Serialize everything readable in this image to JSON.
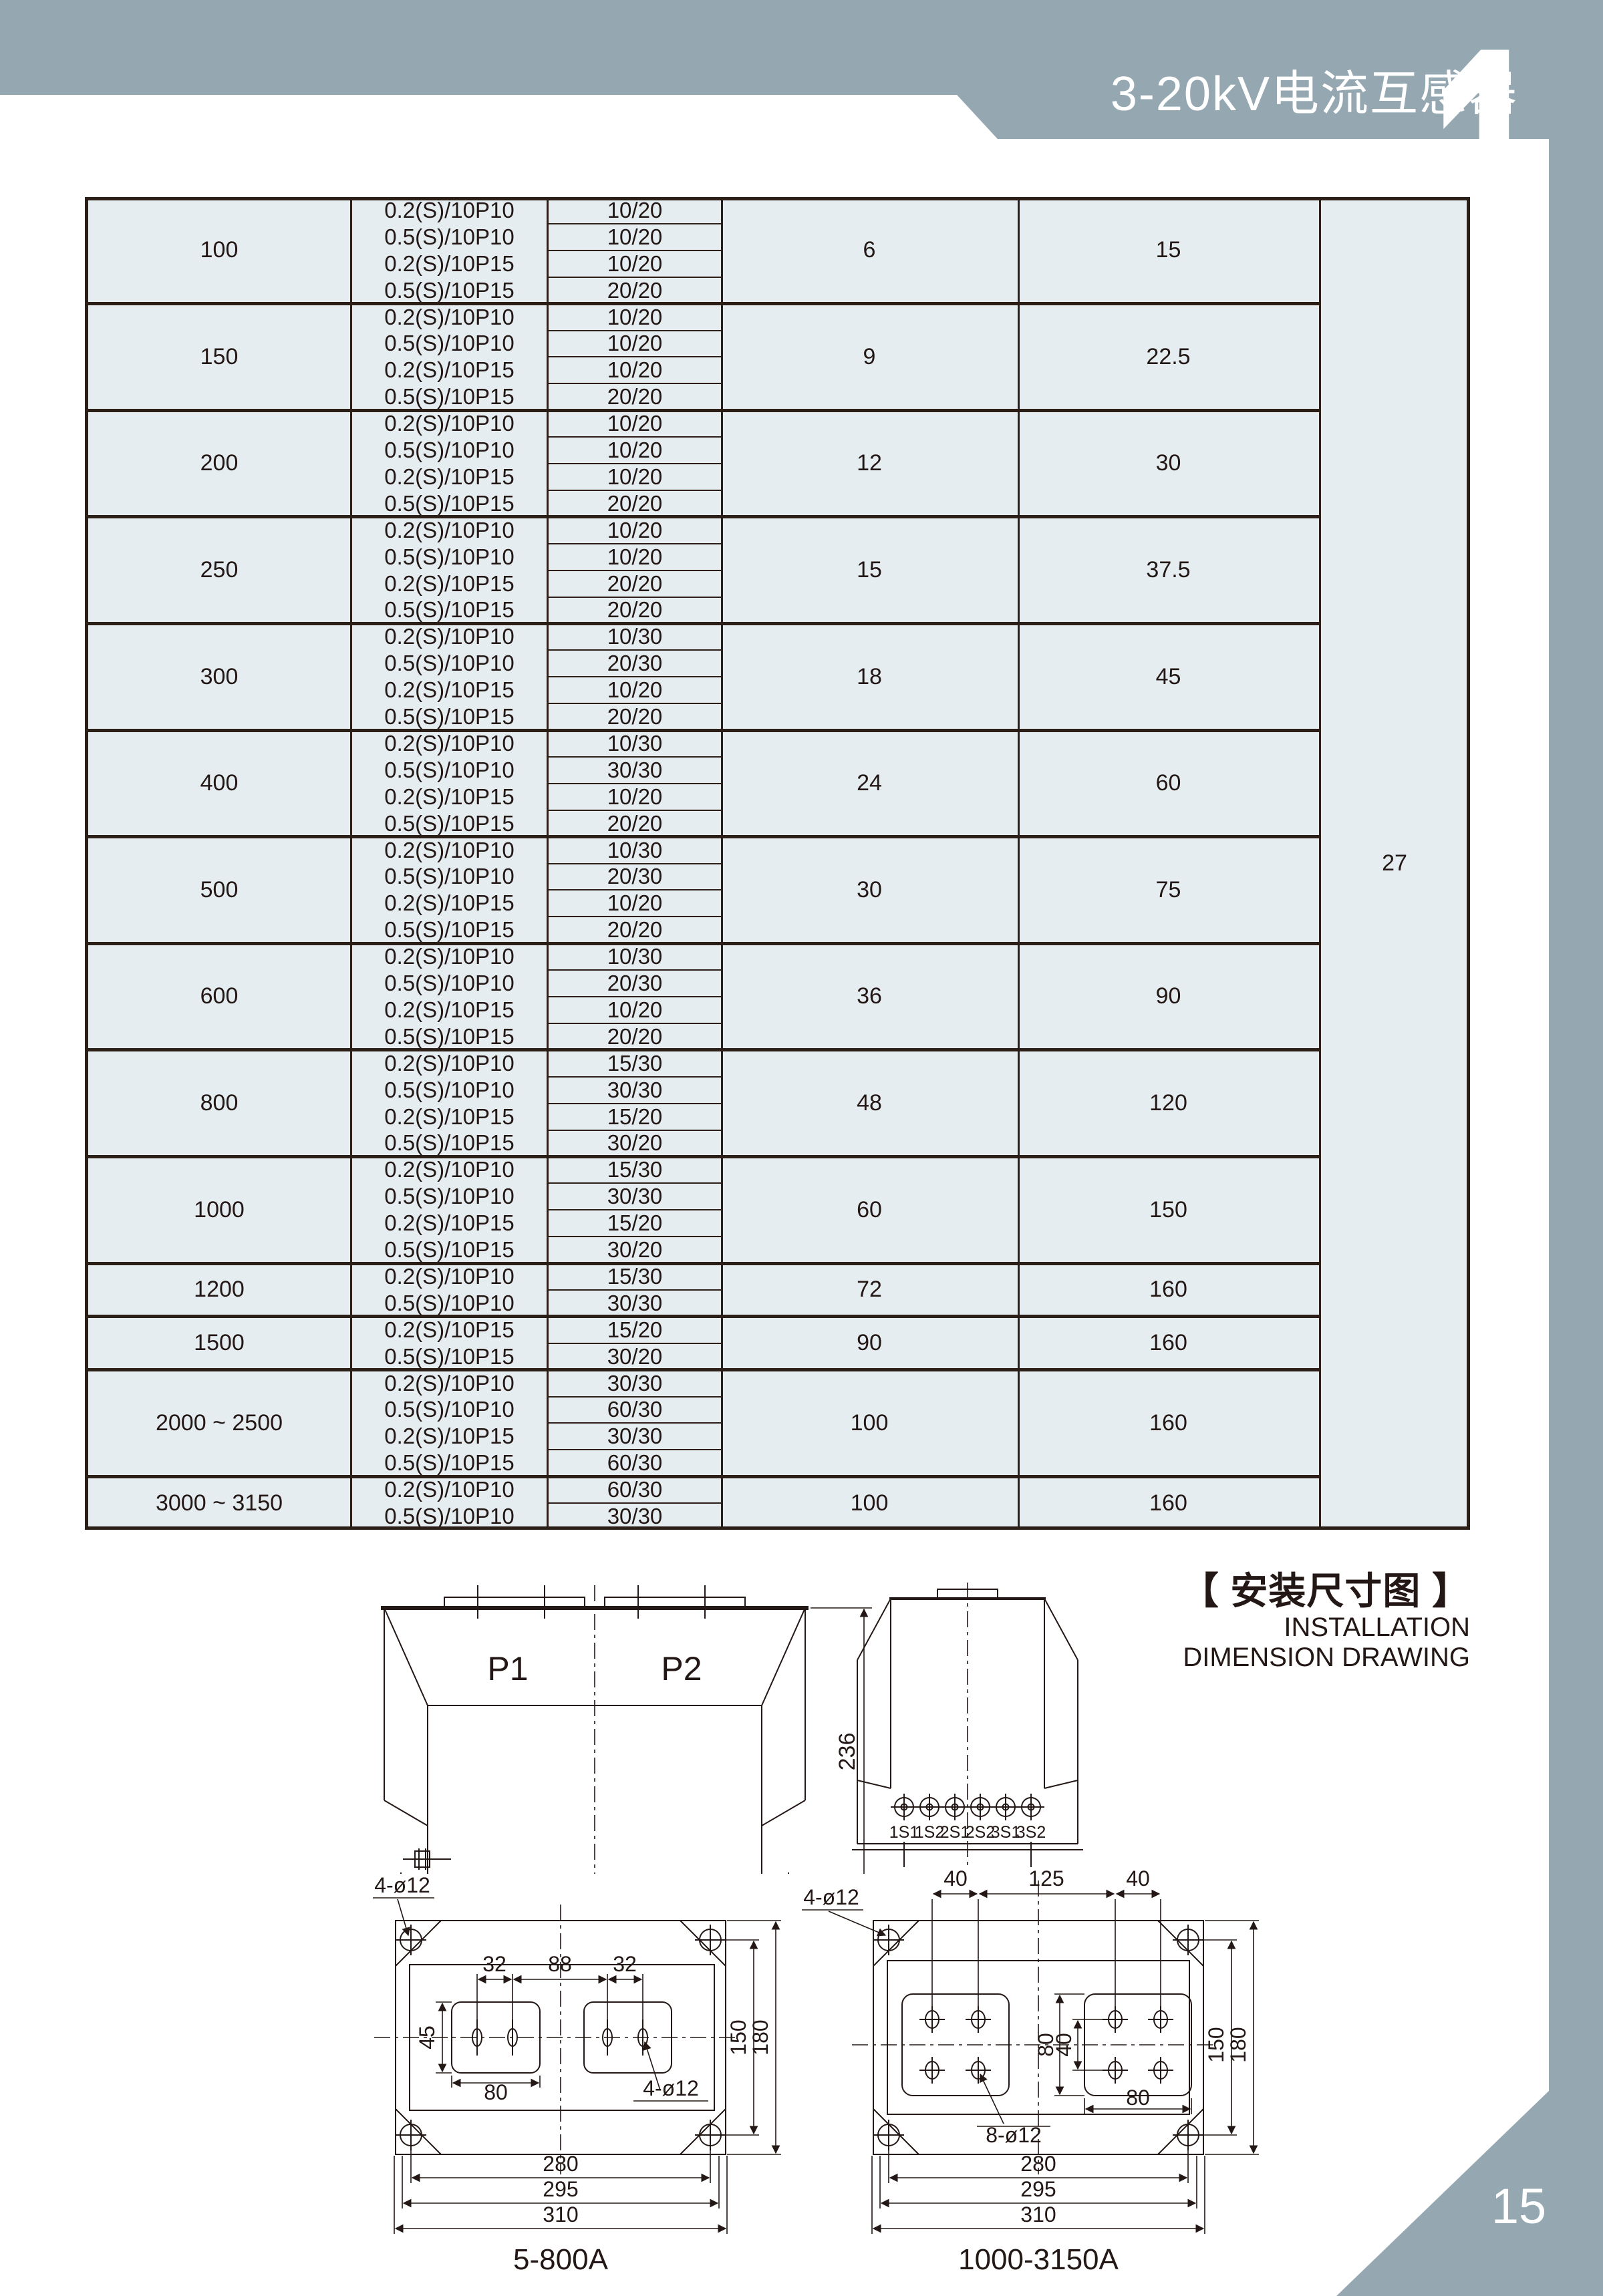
{
  "page": {
    "header_title": "3-20kV电流互感器",
    "chapter_number": "1",
    "page_number": "15",
    "colors": {
      "band": "#95a8b2",
      "table_bg": "#e5edf0",
      "line": "#2b1f18"
    }
  },
  "table": {
    "note_column_value": "27",
    "groups": [
      {
        "current": "100",
        "d": "6",
        "e": "15",
        "rows": [
          [
            "0.2(S)/10P10",
            "10/20"
          ],
          [
            "0.5(S)/10P10",
            "10/20"
          ],
          [
            "0.2(S)/10P15",
            "10/20"
          ],
          [
            "0.5(S)/10P15",
            "20/20"
          ]
        ]
      },
      {
        "current": "150",
        "d": "9",
        "e": "22.5",
        "rows": [
          [
            "0.2(S)/10P10",
            "10/20"
          ],
          [
            "0.5(S)/10P10",
            "10/20"
          ],
          [
            "0.2(S)/10P15",
            "10/20"
          ],
          [
            "0.5(S)/10P15",
            "20/20"
          ]
        ]
      },
      {
        "current": "200",
        "d": "12",
        "e": "30",
        "rows": [
          [
            "0.2(S)/10P10",
            "10/20"
          ],
          [
            "0.5(S)/10P10",
            "10/20"
          ],
          [
            "0.2(S)/10P15",
            "10/20"
          ],
          [
            "0.5(S)/10P15",
            "20/20"
          ]
        ]
      },
      {
        "current": "250",
        "d": "15",
        "e": "37.5",
        "rows": [
          [
            "0.2(S)/10P10",
            "10/20"
          ],
          [
            "0.5(S)/10P10",
            "10/20"
          ],
          [
            "0.2(S)/10P15",
            "20/20"
          ],
          [
            "0.5(S)/10P15",
            "20/20"
          ]
        ]
      },
      {
        "current": "300",
        "d": "18",
        "e": "45",
        "rows": [
          [
            "0.2(S)/10P10",
            "10/30"
          ],
          [
            "0.5(S)/10P10",
            "20/30"
          ],
          [
            "0.2(S)/10P15",
            "10/20"
          ],
          [
            "0.5(S)/10P15",
            "20/20"
          ]
        ]
      },
      {
        "current": "400",
        "d": "24",
        "e": "60",
        "rows": [
          [
            "0.2(S)/10P10",
            "10/30"
          ],
          [
            "0.5(S)/10P10",
            "30/30"
          ],
          [
            "0.2(S)/10P15",
            "10/20"
          ],
          [
            "0.5(S)/10P15",
            "20/20"
          ]
        ]
      },
      {
        "current": "500",
        "d": "30",
        "e": "75",
        "rows": [
          [
            "0.2(S)/10P10",
            "10/30"
          ],
          [
            "0.5(S)/10P10",
            "20/30"
          ],
          [
            "0.2(S)/10P15",
            "10/20"
          ],
          [
            "0.5(S)/10P15",
            "20/20"
          ]
        ]
      },
      {
        "current": "600",
        "d": "36",
        "e": "90",
        "rows": [
          [
            "0.2(S)/10P10",
            "10/30"
          ],
          [
            "0.5(S)/10P10",
            "20/30"
          ],
          [
            "0.2(S)/10P15",
            "10/20"
          ],
          [
            "0.5(S)/10P15",
            "20/20"
          ]
        ]
      },
      {
        "current": "800",
        "d": "48",
        "e": "120",
        "rows": [
          [
            "0.2(S)/10P10",
            "15/30"
          ],
          [
            "0.5(S)/10P10",
            "30/30"
          ],
          [
            "0.2(S)/10P15",
            "15/20"
          ],
          [
            "0.5(S)/10P15",
            "30/20"
          ]
        ]
      },
      {
        "current": "1000",
        "d": "60",
        "e": "150",
        "rows": [
          [
            "0.2(S)/10P10",
            "15/30"
          ],
          [
            "0.5(S)/10P10",
            "30/30"
          ],
          [
            "0.2(S)/10P15",
            "15/20"
          ],
          [
            "0.5(S)/10P15",
            "30/20"
          ]
        ]
      },
      {
        "current": "1200",
        "d": "72",
        "e": "160",
        "rows": [
          [
            "0.2(S)/10P10",
            "15/30"
          ],
          [
            "0.5(S)/10P10",
            "30/30"
          ]
        ]
      },
      {
        "current": "1500",
        "d": "90",
        "e": "160",
        "rows": [
          [
            "0.2(S)/10P15",
            "15/20"
          ],
          [
            "0.5(S)/10P15",
            "30/20"
          ]
        ]
      },
      {
        "current": "2000 ~ 2500",
        "d": "100",
        "e": "160",
        "rows": [
          [
            "0.2(S)/10P10",
            "30/30"
          ],
          [
            "0.5(S)/10P10",
            "60/30"
          ],
          [
            "0.2(S)/10P15",
            "30/30"
          ],
          [
            "0.5(S)/10P15",
            "60/30"
          ]
        ]
      },
      {
        "current": "3000 ~ 3150",
        "d": "100",
        "e": "160",
        "rows": [
          [
            "0.2(S)/10P10",
            "60/30"
          ],
          [
            "0.5(S)/10P10",
            "30/30"
          ]
        ]
      }
    ]
  },
  "drawings": {
    "section_title_zh": "【 安装尺寸图 】",
    "section_title_en1": "INSTALLATION",
    "section_title_en2": "DIMENSION DRAWING",
    "front_view": {
      "p1": "P1",
      "p2": "P2",
      "height_dim": "236"
    },
    "side_view": {
      "terminals": [
        "1S1",
        "1S2",
        "2S1",
        "2S2",
        "3S1",
        "3S2"
      ]
    },
    "top_view_small": {
      "caption": "5-800A",
      "hole_label_tl": "4-ø12",
      "hole_label_br": "4-ø12",
      "dims_top": [
        "32",
        "88",
        "32"
      ],
      "dim_left": "45",
      "dim_pad": "80",
      "dims_right": [
        "150",
        "180"
      ],
      "dims_bottom": [
        "280",
        "295",
        "310"
      ]
    },
    "top_view_large": {
      "caption": "1000-3150A",
      "hole_label_tl": "4-ø12",
      "hole_label_mid": "8-ø12",
      "dims_top": [
        "40",
        "125",
        "40"
      ],
      "dim_inner_a": "80",
      "dim_inner_b": "40",
      "dim_pad": "80",
      "dims_right": [
        "150",
        "180"
      ],
      "dims_bottom": [
        "280",
        "295",
        "310"
      ]
    }
  }
}
